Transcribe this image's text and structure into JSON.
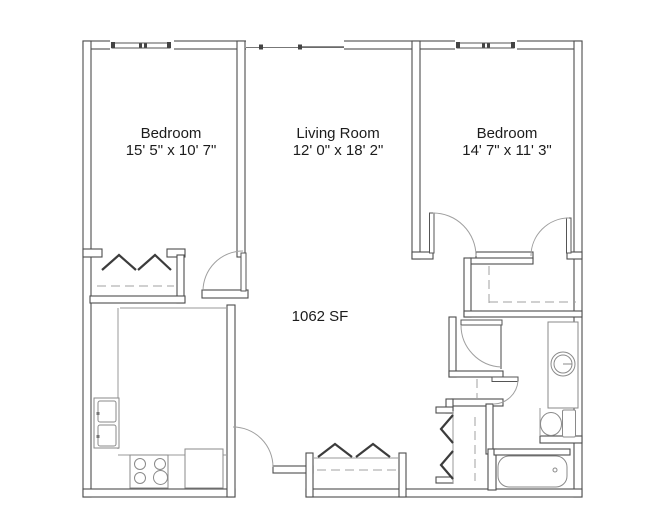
{
  "area_label": "1062 SF",
  "rooms": [
    {
      "name": "Bedroom",
      "dimensions": "15' 5\" x 10' 7\""
    },
    {
      "name": "Living Room",
      "dimensions": "12' 0\" x 18' 2\""
    },
    {
      "name": "Bedroom",
      "dimensions": "14' 7\" x 11' 3\""
    }
  ],
  "fixtures": [
    "kitchen-sink",
    "range-burners",
    "refrigerator",
    "vanity-sink",
    "toilet",
    "bathtub",
    "bifold-closet-doors",
    "closet-rods",
    "swing-doors",
    "windows"
  ],
  "colors": {
    "background": "#ffffff",
    "walls": "#4d4d4d",
    "fixtures": "#8a8a8a",
    "doors": "#9f9f9f",
    "text": "#1c1c1c"
  }
}
